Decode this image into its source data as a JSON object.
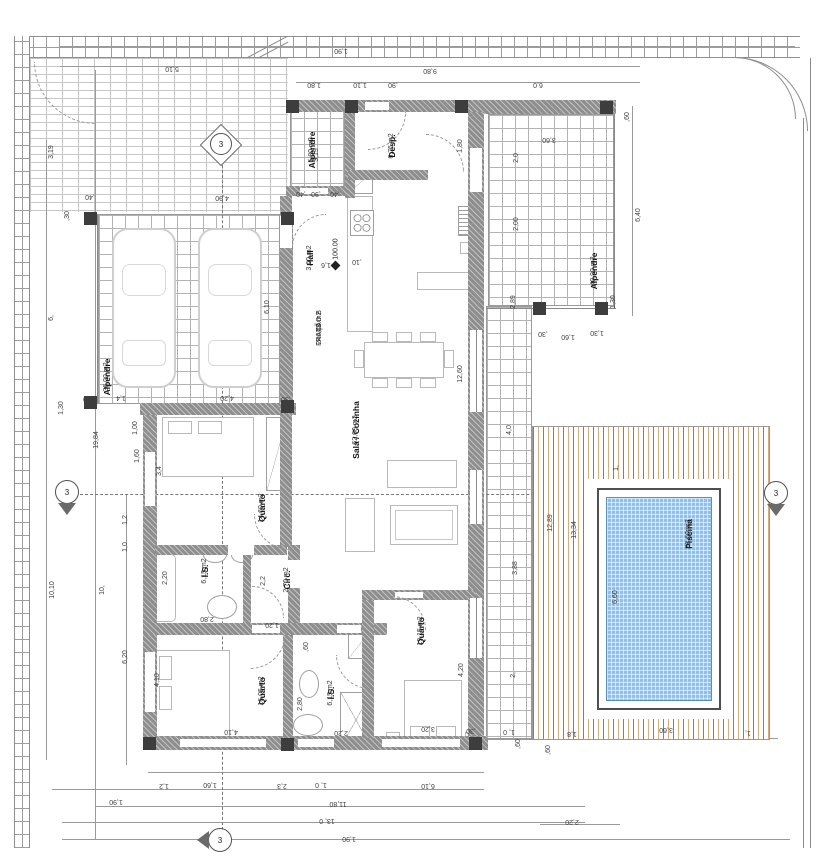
{
  "plan": {
    "unit": {
      "lines": [
        "T3",
        "FRAÇÃO B",
        "246,40 m2"
      ],
      "x": 316,
      "y": 328
    },
    "level_mark": "100.00",
    "section_label": "3",
    "colors": {
      "wall": "#8e8e8e",
      "deck_dark": "#b5723a",
      "deck_light": "#ddab80",
      "pool_water": "#8ec1ee"
    },
    "rooms": [
      {
        "name": "Alpendre",
        "area": "5,80 m2",
        "x": 308,
        "y": 150,
        "r": -90
      },
      {
        "name": "Desp.",
        "area": "6,75 m2",
        "x": 388,
        "y": 146,
        "r": -90
      },
      {
        "name": "Hall",
        "area": "3,60 m2",
        "x": 306,
        "y": 258,
        "r": -90
      },
      {
        "name": "Sala / Cozinha",
        "area": "62,60 m2",
        "x": 352,
        "y": 430,
        "r": -90
      },
      {
        "name": "Quarto",
        "area": "14,60 m2",
        "x": 258,
        "y": 508,
        "r": -90
      },
      {
        "name": "I.S.",
        "area": "6,15 m2",
        "x": 201,
        "y": 571,
        "r": -90
      },
      {
        "name": "Circ.",
        "area": "2,70 m2",
        "x": 283,
        "y": 580,
        "r": -90
      },
      {
        "name": "Quarto",
        "area": "16,05 m2",
        "x": 258,
        "y": 691,
        "r": -90
      },
      {
        "name": "I.S.",
        "area": "6,15 m2",
        "x": 327,
        "y": 693,
        "r": -90
      },
      {
        "name": "Quarto",
        "area": "19,15 m2",
        "x": 417,
        "y": 631,
        "r": -90
      },
      {
        "name": "Alpendre",
        "area": "36,00 m2",
        "x": 103,
        "y": 377,
        "r": -90
      },
      {
        "name": "Alpendre",
        "area": "40,90 m2",
        "x": 590,
        "y": 271,
        "r": -90
      },
      {
        "name": "Piscina",
        "area": "23,60 m2",
        "x": 685,
        "y": 534,
        "r": -90
      }
    ],
    "dimensions": [
      {
        "t": "5,10",
        "x": 172,
        "y": 68,
        "r": 180
      },
      {
        "t": "1,90",
        "x": 341,
        "y": 50,
        "r": 180
      },
      {
        "t": "9,80",
        "x": 430,
        "y": 70,
        "r": 180
      },
      {
        "t": "1,80",
        "x": 314,
        "y": 84,
        "r": 180
      },
      {
        "t": "1,10",
        "x": 360,
        "y": 84,
        "r": 180
      },
      {
        "t": ",90",
        "x": 393,
        "y": 84,
        "r": 180
      },
      {
        "t": "6,0",
        "x": 538,
        "y": 84,
        "r": 180
      },
      {
        "t": ",60",
        "x": 628,
        "y": 117,
        "r": -90
      },
      {
        "t": "3,60",
        "x": 549,
        "y": 139,
        "r": 180
      },
      {
        "t": "2,0",
        "x": 517,
        "y": 158,
        "r": -90
      },
      {
        "t": "2,00",
        "x": 517,
        "y": 224,
        "r": -90
      },
      {
        "t": "6,40",
        "x": 639,
        "y": 215,
        "r": -90
      },
      {
        "t": "1,30",
        "x": 614,
        "y": 302,
        "r": -90
      },
      {
        "t": "2,89",
        "x": 514,
        "y": 302,
        "r": -90
      },
      {
        "t": ",30",
        "x": 543,
        "y": 333,
        "r": 180
      },
      {
        "t": "1,60",
        "x": 568,
        "y": 336,
        "r": 180
      },
      {
        "t": "1,30",
        "x": 597,
        "y": 332,
        "r": 180
      },
      {
        "t": "1,80",
        "x": 461,
        "y": 146,
        "r": -90
      },
      {
        "t": ",30",
        "x": 462,
        "y": 107,
        "r": -90
      },
      {
        "t": "4,0",
        "x": 510,
        "y": 430,
        "r": -90
      },
      {
        "t": "3,88",
        "x": 516,
        "y": 568,
        "r": -90
      },
      {
        "t": "2,",
        "x": 514,
        "y": 675,
        "r": -90
      },
      {
        "t": "12,89",
        "x": 551,
        "y": 523,
        "r": -90
      },
      {
        "t": "13,34",
        "x": 575,
        "y": 530,
        "r": -90
      },
      {
        "t": "1,",
        "x": 617,
        "y": 468,
        "r": -90
      },
      {
        "t": "6,60",
        "x": 616,
        "y": 597,
        "r": -90
      },
      {
        "t": "3,60",
        "x": 666,
        "y": 729,
        "r": 180
      },
      {
        "t": "1,8",
        "x": 572,
        "y": 733,
        "r": 180
      },
      {
        "t": "1,",
        "x": 748,
        "y": 732,
        "r": 180
      },
      {
        "t": "1, 0",
        "x": 509,
        "y": 731,
        "r": 180
      },
      {
        "t": ",30",
        "x": 471,
        "y": 730,
        "r": 180
      },
      {
        "t": ",60",
        "x": 519,
        "y": 744,
        "r": -90
      },
      {
        "t": ",60",
        "x": 549,
        "y": 750,
        "r": -90
      },
      {
        "t": "2,20",
        "x": 572,
        "y": 821,
        "r": 180
      },
      {
        "t": "12,60",
        "x": 461,
        "y": 374,
        "r": -90
      },
      {
        "t": "1,6",
        "x": 326,
        "y": 264,
        "r": 180
      },
      {
        "t": ",10",
        "x": 357,
        "y": 261,
        "r": 180
      },
      {
        "t": ",40",
        "x": 301,
        "y": 193,
        "r": 180
      },
      {
        "t": ",90",
        "x": 316,
        "y": 193,
        "r": 180
      },
      {
        "t": ",40",
        "x": 335,
        "y": 193,
        "r": 180
      },
      {
        "t": "3,19",
        "x": 317,
        "y": 155,
        "r": -90
      },
      {
        "t": ",40",
        "x": 90,
        "y": 196,
        "r": 180
      },
      {
        "t": "4,90",
        "x": 222,
        "y": 197,
        "r": 180
      },
      {
        "t": "6,10",
        "x": 268,
        "y": 307,
        "r": -90
      },
      {
        "t": ",30",
        "x": 88,
        "y": 398,
        "r": 180
      },
      {
        "t": "1,4",
        "x": 121,
        "y": 397,
        "r": 180
      },
      {
        "t": "4,20",
        "x": 227,
        "y": 397,
        "r": 180
      },
      {
        "t": ",30",
        "x": 286,
        "y": 398,
        "r": 180
      },
      {
        "t": "19,84",
        "x": 97,
        "y": 440,
        "r": -90
      },
      {
        "t": "3,19",
        "x": 52,
        "y": 152,
        "r": -90
      },
      {
        "t": ",30",
        "x": 68,
        "y": 216,
        "r": -90
      },
      {
        "t": "6,",
        "x": 52,
        "y": 318,
        "r": -90
      },
      {
        "t": "1,30",
        "x": 62,
        "y": 408,
        "r": -90
      },
      {
        "t": "10,10",
        "x": 53,
        "y": 590,
        "r": -90
      },
      {
        "t": "10,",
        "x": 103,
        "y": 590,
        "r": -90
      },
      {
        "t": "6,20",
        "x": 126,
        "y": 657,
        "r": -90
      },
      {
        "t": "1,2",
        "x": 126,
        "y": 520,
        "r": -90
      },
      {
        "t": "1,0",
        "x": 126,
        "y": 547,
        "r": -90
      },
      {
        "t": "1,00",
        "x": 136,
        "y": 428,
        "r": -90
      },
      {
        "t": "1,60",
        "x": 138,
        "y": 456,
        "r": -90
      },
      {
        "t": "3,4",
        "x": 160,
        "y": 471,
        "r": -90
      },
      {
        "t": "4,10",
        "x": 158,
        "y": 680,
        "r": -90
      },
      {
        "t": "2,20",
        "x": 166,
        "y": 578,
        "r": -90
      },
      {
        "t": "2,2",
        "x": 264,
        "y": 581,
        "r": -90
      },
      {
        "t": "2,80",
        "x": 207,
        "y": 618,
        "r": 180
      },
      {
        "t": "1,20",
        "x": 272,
        "y": 624,
        "r": 180
      },
      {
        "t": ",60",
        "x": 307,
        "y": 647,
        "r": -90
      },
      {
        "t": "2,80",
        "x": 301,
        "y": 704,
        "r": -90
      },
      {
        "t": "2,20",
        "x": 341,
        "y": 732,
        "r": 180
      },
      {
        "t": "3,20",
        "x": 428,
        "y": 728,
        "r": 180
      },
      {
        "t": "4,20",
        "x": 462,
        "y": 670,
        "r": -90
      },
      {
        "t": "4,10",
        "x": 231,
        "y": 731,
        "r": 180
      },
      {
        "t": "1,2",
        "x": 164,
        "y": 785,
        "r": 180
      },
      {
        "t": "1,60",
        "x": 210,
        "y": 784,
        "r": 180
      },
      {
        "t": "2,3",
        "x": 282,
        "y": 785,
        "r": 180
      },
      {
        "t": "1, 0",
        "x": 321,
        "y": 784,
        "r": 180
      },
      {
        "t": "6,10",
        "x": 428,
        "y": 785,
        "r": 180
      },
      {
        "t": "1,90",
        "x": 116,
        "y": 801,
        "r": 180
      },
      {
        "t": "11,80",
        "x": 338,
        "y": 803,
        "r": 180
      },
      {
        "t": "13, 0",
        "x": 327,
        "y": 820,
        "r": 180
      },
      {
        "t": "1,90",
        "x": 349,
        "y": 838,
        "r": 180
      }
    ]
  }
}
